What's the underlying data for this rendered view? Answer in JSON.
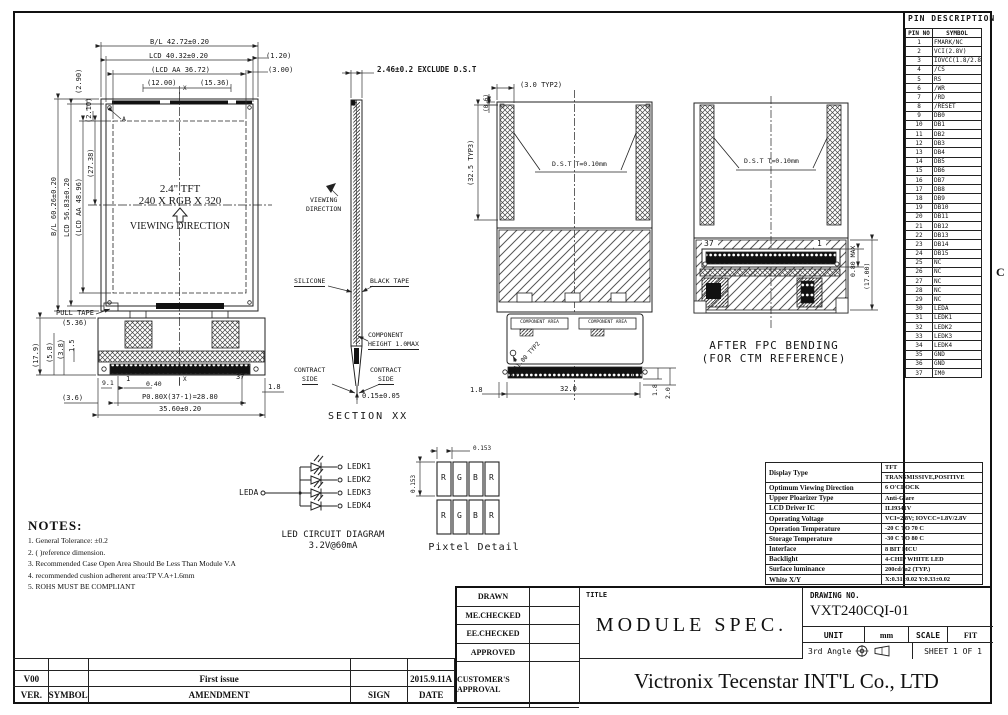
{
  "margin": {
    "zone": "C"
  },
  "front_view": {
    "label_a": "A",
    "panel_line1": "2.4\" TFT",
    "panel_line2": "240 X RGB X 320",
    "viewing_direction": "VIEWING DIRECTION",
    "dim_bl_w": "B/L 42.72±0.20",
    "dim_lcd_w": "LCD 40.32±0.20",
    "dim_aa_w": "(LCD AA 36.72)",
    "dim_12": "(12.00)",
    "dim_1536": "(15.36)",
    "dim_120": "(1.20)",
    "dim_300": "(3.00)",
    "dim_290": "(2.90)",
    "dim_210": "(2.10)",
    "dim_bl_h": "B/L 60.26±0.20",
    "dim_lcd_h": "LCD 56.83±0.20",
    "dim_aa_h": "(LCD AA 48.96)",
    "dim_2738": "(27.38)",
    "pull_tape": "PULL TAPE",
    "dim_536": "(5.36)",
    "dim_179": "(17.9)",
    "dim_58": "(5.8)",
    "dim_38": "(3.8)",
    "dim_15": "1.5",
    "dim_91": "9.1",
    "dim_040": "0.40",
    "dim_pitch": "P0.80X(37-1)=28.80",
    "dim_total": "35.60±0.20",
    "dim_36": "(3.6)",
    "dim_18": "1.8",
    "pin_first": "1",
    "pin_last": "37",
    "x_top": "X",
    "x_bottom": "X"
  },
  "section_view": {
    "dim_top": "2.46±0.2 EXCLUDE D.S.T",
    "viewing_1": "VIEWING",
    "viewing_2": "DIRECTION",
    "silicone": "SILICONE",
    "black_tape": "BLACK TAPE",
    "comp_1": "COMPONENT",
    "comp_2": "HEIGHT 1.0MAX",
    "contract_l1": "CONTRACT",
    "contract_l2": "SIDE",
    "contract_r1": "CONTRACT",
    "contract_r2": "SIDE",
    "dim_bottom": "0.15±0.05",
    "caption": "SECTION XX"
  },
  "rear_view": {
    "dim_30": "(3.0 TYP2)",
    "dim_06": "(0.6)",
    "dim_325": "(32.5 TYP3)",
    "dst": "D.S.T T=0.10mm",
    "comp_area_1": "COMPONENT AREA",
    "comp_area_2": "COMPONENT AREA",
    "hole": "Φ1.00 TYP2",
    "pin_last": "37",
    "pin_first": "1",
    "dim_18l": "1.8",
    "dim_32": "32.0",
    "dim_18r": "1.8",
    "dim_20": "2.0"
  },
  "bent_view": {
    "dst": "D.S.T T=0.10mm",
    "pin_last": "37",
    "pin_first": "1",
    "dim_080": "0.80 MAX",
    "dim_17": "(17.00)",
    "caption_1": "AFTER FPC BENDING",
    "caption_2": "(FOR CTM REFERENCE)"
  },
  "led_diagram": {
    "anode_label": "LEDA",
    "cathodes": [
      "LEDK1",
      "LEDK2",
      "LEDK3",
      "LEDK4"
    ],
    "caption_1": "LED CIRCUIT DIAGRAM",
    "caption_2": "3.2V@60mA"
  },
  "pixel_detail": {
    "dim_h": "0.153",
    "dim_v": "0.153",
    "cells": [
      "R",
      "G",
      "B",
      "R"
    ],
    "caption": "Pixtel Detail"
  },
  "notes": {
    "title": "NOTES:",
    "items": [
      "1. General Tolerance: ±0.2",
      "2. ( )reference dimension.",
      "3. Recommended Case Open Area Should Be Less Than Module V.A",
      "4. recommended cushion adherent area:TP V.A+1.6mm",
      "5. ROHS MUST BE COMPLIANT"
    ]
  },
  "pin_table": {
    "title": "PIN DESCRIPTION",
    "headers": {
      "no": "PIN NO",
      "symbol": "SYMBOL"
    },
    "rows": [
      {
        "no": "1",
        "symbol": "FMARK/NC"
      },
      {
        "no": "2",
        "symbol": "VCI(2.8V)"
      },
      {
        "no": "3",
        "symbol": "IOVCC(1.8/2.8V)"
      },
      {
        "no": "4",
        "symbol": "/CS"
      },
      {
        "no": "5",
        "symbol": "RS"
      },
      {
        "no": "6",
        "symbol": "/WR"
      },
      {
        "no": "7",
        "symbol": "/RD"
      },
      {
        "no": "8",
        "symbol": "/RESET"
      },
      {
        "no": "9",
        "symbol": "DB0"
      },
      {
        "no": "10",
        "symbol": "DB1"
      },
      {
        "no": "11",
        "symbol": "DB2"
      },
      {
        "no": "12",
        "symbol": "DB3"
      },
      {
        "no": "13",
        "symbol": "DB4"
      },
      {
        "no": "14",
        "symbol": "DB5"
      },
      {
        "no": "15",
        "symbol": "DB6"
      },
      {
        "no": "16",
        "symbol": "DB7"
      },
      {
        "no": "17",
        "symbol": "DB8"
      },
      {
        "no": "18",
        "symbol": "DB9"
      },
      {
        "no": "19",
        "symbol": "DB10"
      },
      {
        "no": "20",
        "symbol": "DB11"
      },
      {
        "no": "21",
        "symbol": "DB12"
      },
      {
        "no": "22",
        "symbol": "DB13"
      },
      {
        "no": "23",
        "symbol": "DB14"
      },
      {
        "no": "24",
        "symbol": "DB15"
      },
      {
        "no": "25",
        "symbol": "NC"
      },
      {
        "no": "26",
        "symbol": "NC"
      },
      {
        "no": "27",
        "symbol": "NC"
      },
      {
        "no": "28",
        "symbol": "NC"
      },
      {
        "no": "29",
        "symbol": "NC"
      },
      {
        "no": "30",
        "symbol": "LEDA"
      },
      {
        "no": "31",
        "symbol": "LEDK1"
      },
      {
        "no": "32",
        "symbol": "LEDK2"
      },
      {
        "no": "33",
        "symbol": "LEDK3"
      },
      {
        "no": "34",
        "symbol": "LEDK4"
      },
      {
        "no": "35",
        "symbol": "GND"
      },
      {
        "no": "36",
        "symbol": "GND"
      },
      {
        "no": "37",
        "symbol": "IM0"
      }
    ]
  },
  "spec_table": {
    "display_type_label": "Display Type",
    "display_type_value1": "TFT",
    "display_type_value2": "TRANSMISSIVE,POSITIVE",
    "rows": [
      {
        "label": "Optimum Viewing Direction",
        "value": "6 O'CLOCK"
      },
      {
        "label": "Upper Ploarizer Type",
        "value": "Anti-Glare"
      },
      {
        "label": "LCD Driver IC",
        "value": "ILI9341V"
      },
      {
        "label": "Operating Voltage",
        "value": "VCI=2.8V; IOVCC=1.8V/2.8V"
      },
      {
        "label": "Operation Temperature",
        "value": "-20 C TO 70 C"
      },
      {
        "label": "Storage Temperature",
        "value": "-30 C TO 80 C"
      },
      {
        "label": "Interface",
        "value": "8 BIT MCU"
      },
      {
        "label": "Backlight",
        "value": "4-CHIP WHITE LED"
      },
      {
        "label": "Surface luminance",
        "value": "200cd/m2 (TYP.)"
      },
      {
        "label": "White X/Y",
        "value": "X:0.31±0.02 Y:0.33±0.02"
      }
    ]
  },
  "title_block": {
    "approval_rows": [
      "DRAWN",
      "ME.CHECKED",
      "EE.CHECKED",
      "APPROVED"
    ],
    "customer_approval": "CUSTOMER'S APPROVAL",
    "title_label": "TITLE",
    "title": "MODULE SPEC.",
    "drawing_no_label": "DRAWING NO.",
    "drawing_no": "VXT240CQI-01",
    "unit_label": "UNIT",
    "unit_value": "mm",
    "scale_label": "SCALE",
    "scale_value": "FIT",
    "angle_label": "3rd Angle",
    "sheet_label": "SHEET 1 OF 1",
    "company": "Victronix Tecenstar INT'L Co., LTD"
  },
  "revision_table": {
    "rows": [
      {
        "ver": "V00",
        "symbol": "",
        "amendment": "First issue",
        "sign": "",
        "date": "2015.9.11A"
      }
    ],
    "headers": {
      "ver": "VER.",
      "symbol": "SYMBOL",
      "amendment": "AMENDMENT",
      "sign": "SIGN",
      "date": "DATE"
    }
  }
}
